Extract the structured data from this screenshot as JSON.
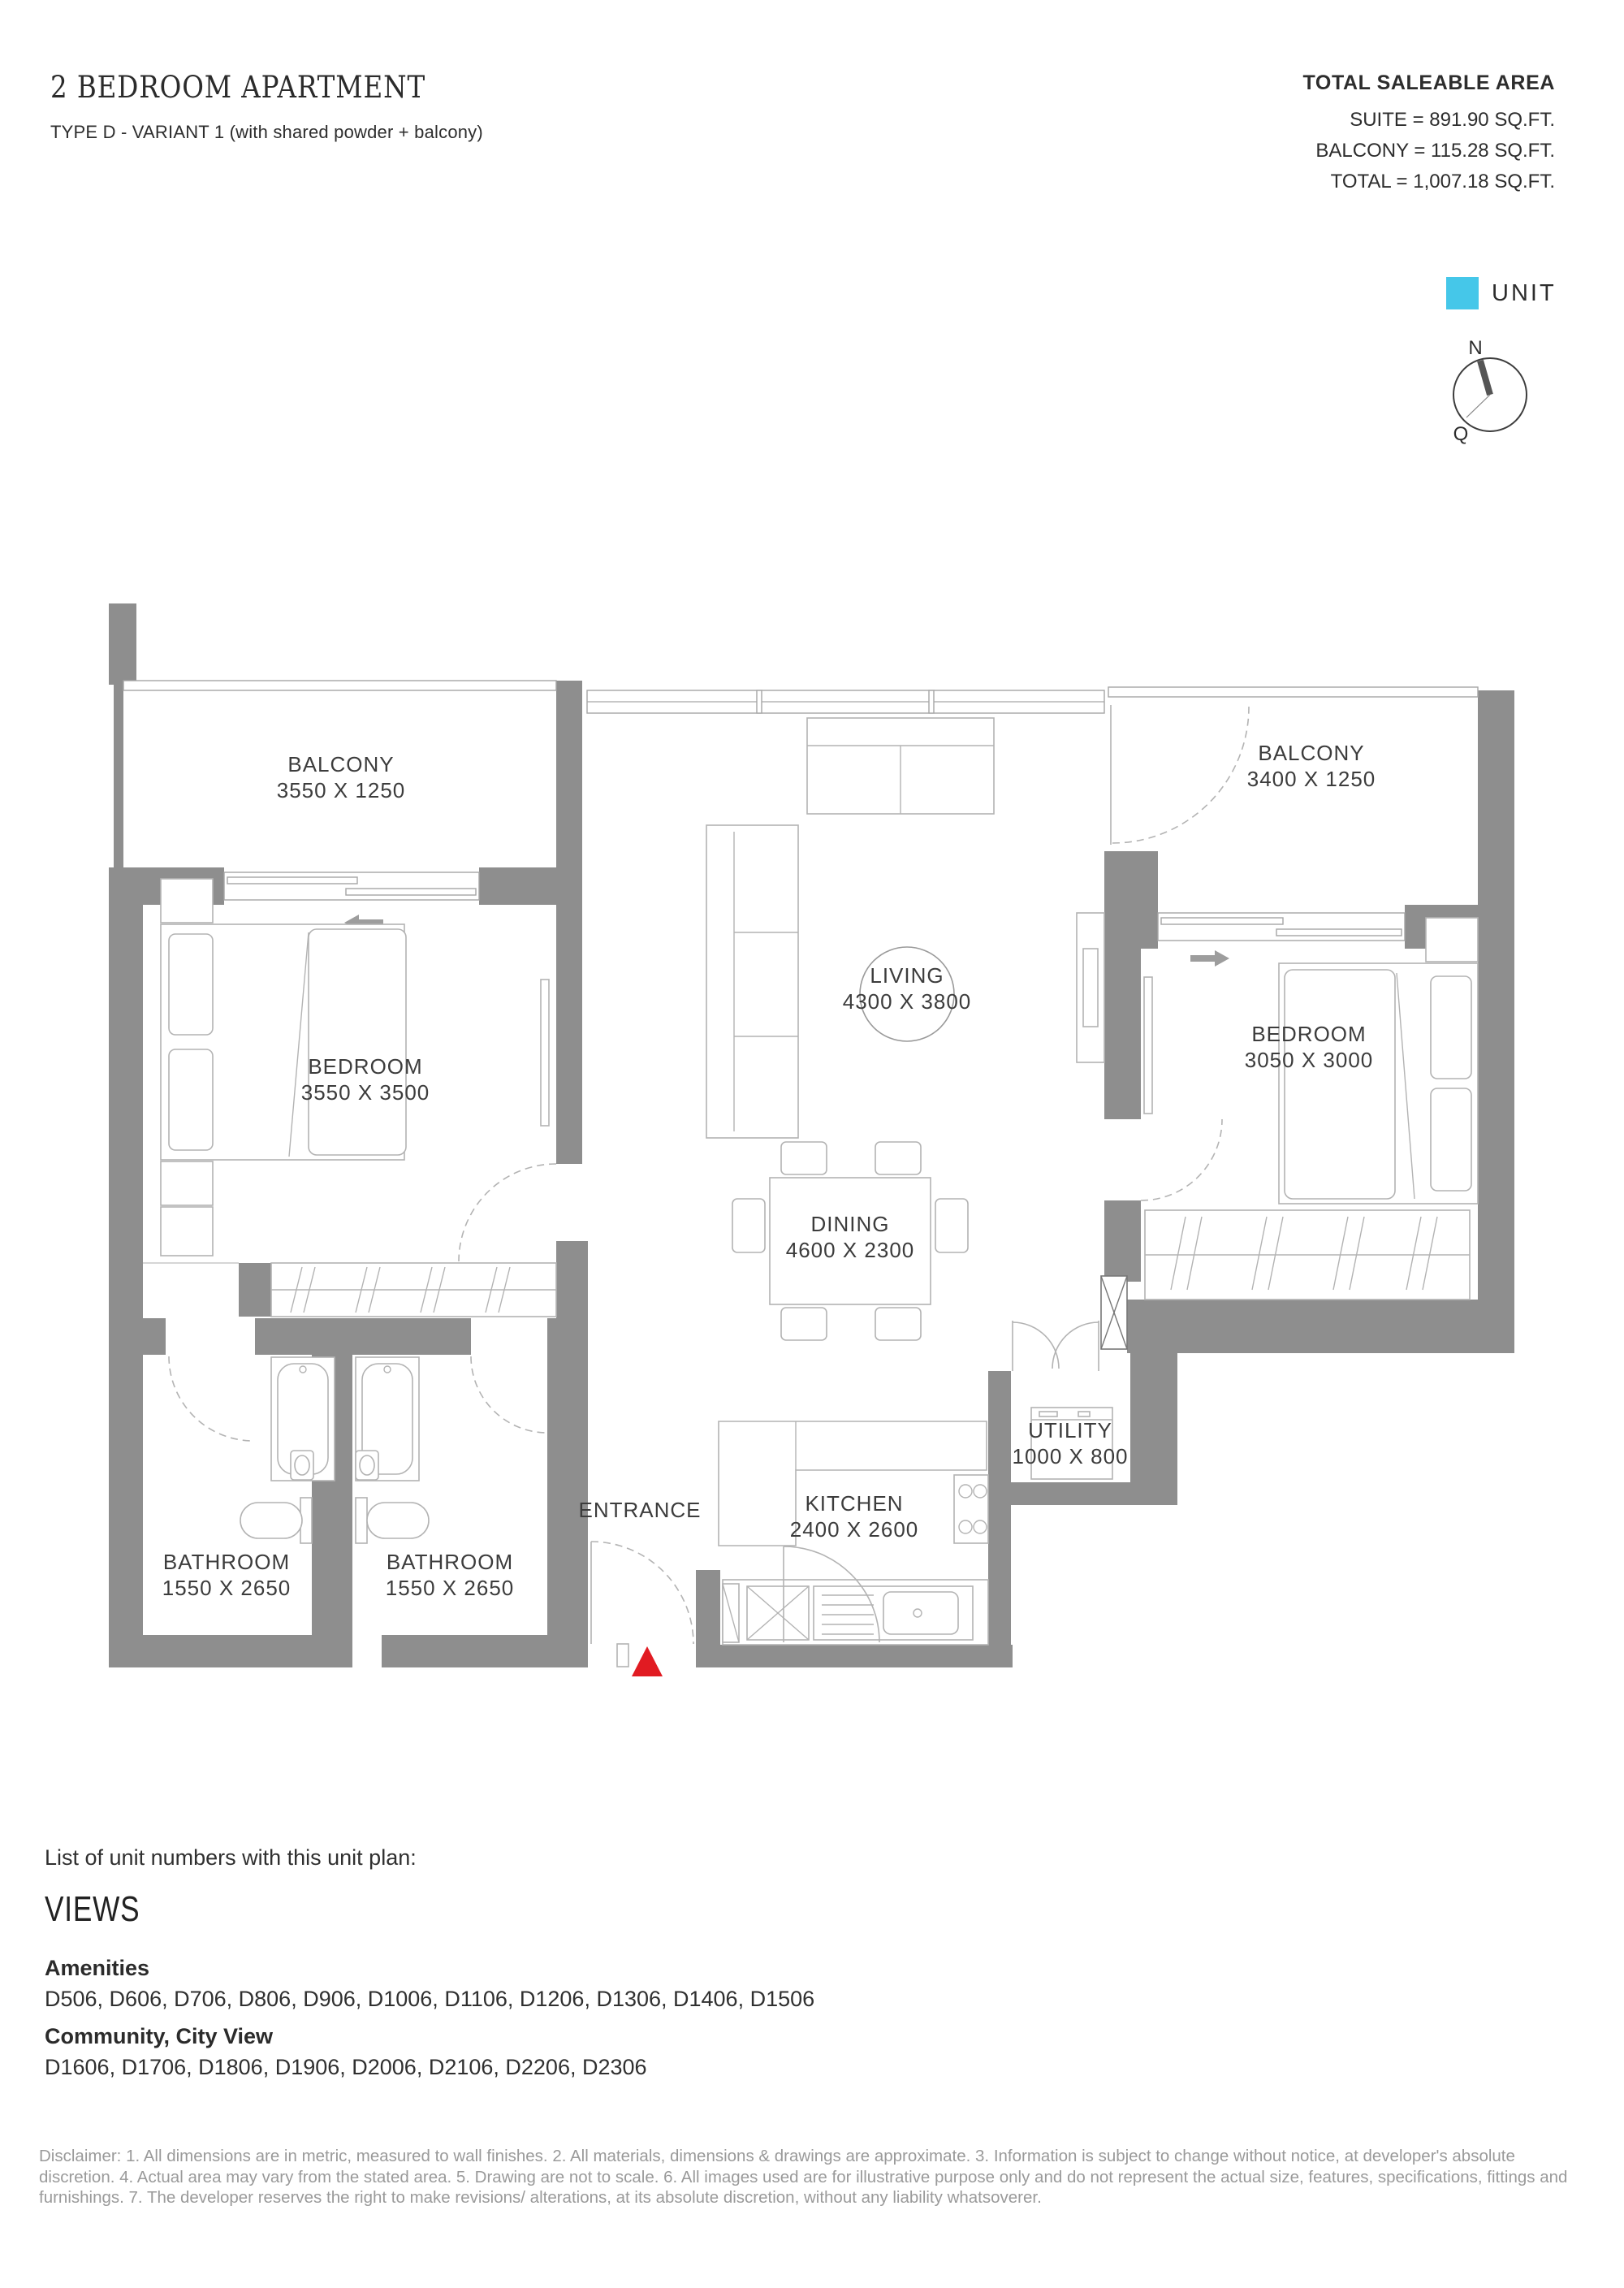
{
  "header": {
    "title": "2 BEDROOM APARTMENT",
    "subtitle": "TYPE D - VARIANT 1 (with shared powder + balcony)"
  },
  "area_summary": {
    "heading": "TOTAL SALEABLE AREA",
    "lines": [
      "SUITE = 891.90 SQ.FT.",
      "BALCONY = 115.28 SQ.FT.",
      "TOTAL = 1,007.18 SQ.FT."
    ]
  },
  "legend": {
    "unit_label": "UNIT"
  },
  "compass": {
    "north": "N",
    "q": "Q"
  },
  "floorplan": {
    "rooms": [
      {
        "name": "BALCONY",
        "dims": "3550 X 1250"
      },
      {
        "name": "BEDROOM",
        "dims": "3550 X 3500"
      },
      {
        "name": "LIVING",
        "dims": "4300 X 3800"
      },
      {
        "name": "DINING",
        "dims": "4600 X 2300"
      },
      {
        "name": "BALCONY",
        "dims": "3400 X 1250"
      },
      {
        "name": "BEDROOM",
        "dims": "3050 X 3000"
      },
      {
        "name": "UTILITY",
        "dims": "1000 X 800"
      },
      {
        "name": "KITCHEN",
        "dims": "2400 X 2600"
      },
      {
        "name": "BATHROOM",
        "dims": "1550 X 2650"
      },
      {
        "name": "BATHROOM",
        "dims": "1550 X 2650"
      }
    ],
    "entrance_label": "ENTRANCE"
  },
  "unit_list": {
    "intro": "List of unit numbers with this unit plan:",
    "views_heading": "VIEWS",
    "groups": [
      {
        "title": "Amenities",
        "units": "D506, D606, D706, D806, D906, D1006, D1106, D1206, D1306, D1406, D1506"
      },
      {
        "title": "Community, City View",
        "units": "D1606, D1706, D1806, D1906, D2006, D2106, D2206, D2306"
      }
    ]
  },
  "disclaimer": "Disclaimer: 1. All dimensions are in metric, measured to wall finishes. 2. All materials, dimensions & drawings are approximate. 3. Information is subject to change without notice, at developer's absolute discretion. 4. Actual area may vary from the stated area. 5. Drawing are not to scale. 6. All images used are for illustrative purpose only and do not represent the actual size, features, specifications, fittings and furnishings. 7. The developer reserves the right to make revisions/ alterations, at its absolute discretion, without any liability whatsoverer.",
  "colors": {
    "unit_swatch": "#45C7E9",
    "entrance_marker": "#E11B22",
    "wall": "#8E8E8E"
  }
}
